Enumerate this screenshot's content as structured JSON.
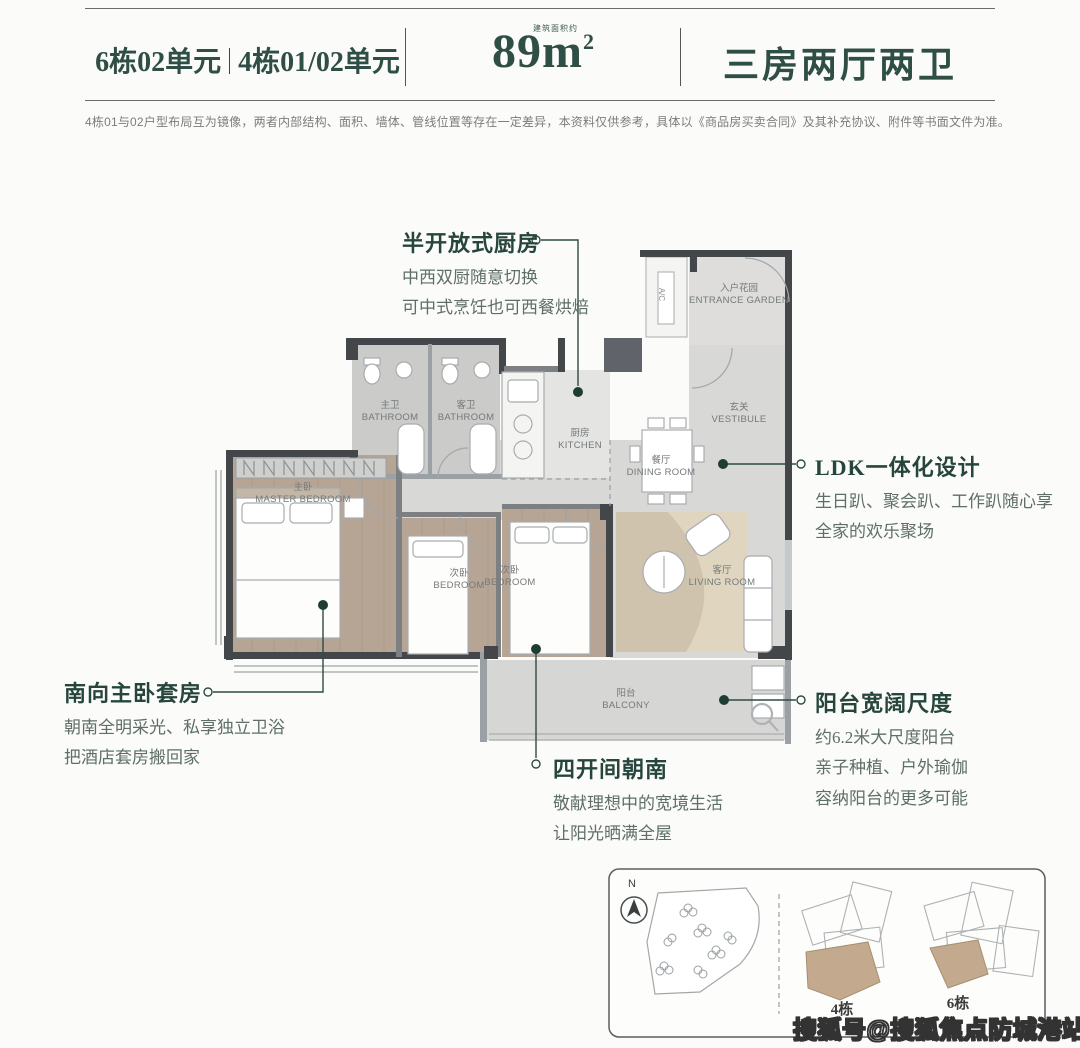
{
  "header": {
    "unit_title_left": "6栋02单元",
    "unit_title_right": "4栋01/02单元",
    "area_number": "89m",
    "area_sup": "2",
    "area_note": "建筑面积约",
    "layout_title": "三房两厅两卫"
  },
  "disclaimer": "4栋01与02户型布局互为镜像，两者内部结构、面积、墙体、管线位置等存在一定差异，本资料仅供参考，具体以《商品房买卖合同》及其补充协议、附件等书面文件为准。",
  "annotations": {
    "kitchen": {
      "title": "半开放式厨房",
      "lines": [
        "中西双厨随意切换",
        "可中式烹饪也可西餐烘焙"
      ]
    },
    "ldk": {
      "title": "LDK一体化设计",
      "lines": [
        "生日趴、聚会趴、工作趴随心享",
        "全家的欢乐聚场"
      ]
    },
    "master": {
      "title": "南向主卧套房",
      "lines": [
        "朝南全明采光、私享独立卫浴",
        "把酒店套房搬回家"
      ]
    },
    "balcony": {
      "title": "阳台宽阔尺度",
      "lines": [
        "约6.2米大尺度阳台",
        "亲子种植、户外瑜伽",
        "容纳阳台的更多可能"
      ]
    },
    "south": {
      "title": "四开间朝南",
      "lines": [
        "敬献理想中的宽境生活",
        "让阳光晒满全屋"
      ]
    }
  },
  "rooms": {
    "entrance_garden": {
      "zh": "入户花园",
      "en": "ENTRANCE GARDEN"
    },
    "vestibule": {
      "zh": "玄关",
      "en": "VESTIBULE"
    },
    "master_bath": {
      "zh": "主卫",
      "en": "BATHROOM"
    },
    "guest_bath": {
      "zh": "客卫",
      "en": "BATHROOM"
    },
    "kitchen": {
      "zh": "厨房",
      "en": "KITCHEN"
    },
    "dining": {
      "zh": "餐厅",
      "en": "DINING ROOM"
    },
    "living": {
      "zh": "客厅",
      "en": "LIVING ROOM"
    },
    "master_bedroom": {
      "zh": "主卧",
      "en": "MASTER BEDROOM"
    },
    "bedroom_2": {
      "zh": "次卧",
      "en": "BEDROOM"
    },
    "bedroom_3": {
      "zh": "次卧",
      "en": "BEDROOM"
    },
    "balcony": {
      "zh": "阳台",
      "en": "BALCONY"
    },
    "ac": "A/C"
  },
  "siteplan": {
    "compass_label": "N",
    "building_4": "4栋",
    "building_6": "6栋"
  },
  "watermark": "搜狐号@搜狐焦点防城港站",
  "colors": {
    "accent_green": "#2e4b42",
    "leader_dot": "#1e3d34",
    "body_text": "#5e6e68",
    "highlight_tan": "#c3aa8f"
  }
}
